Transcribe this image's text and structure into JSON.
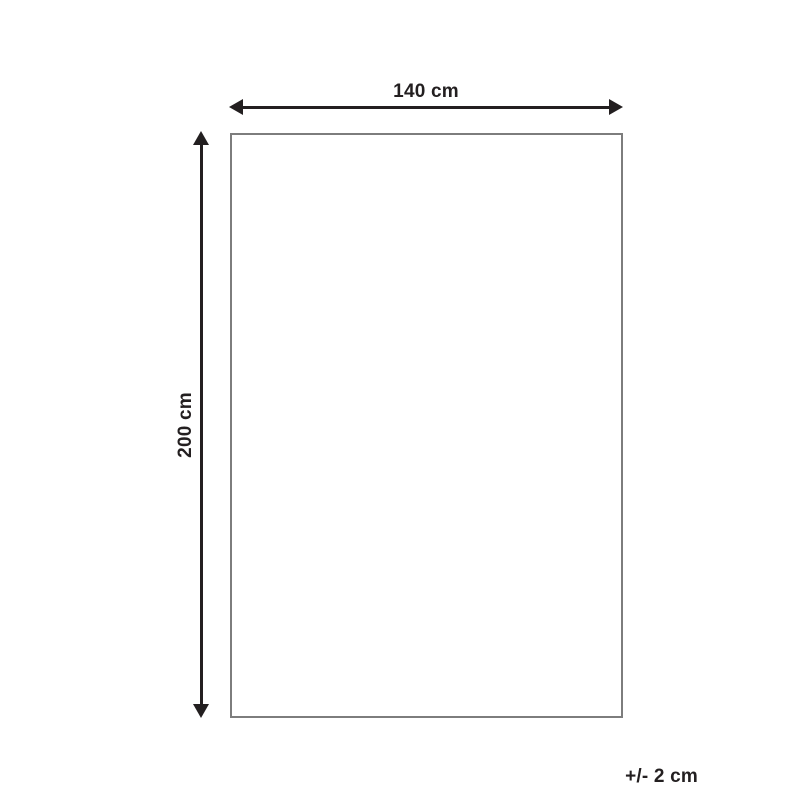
{
  "diagram": {
    "type": "product-dimension-diagram",
    "width_label": "140 cm",
    "height_label": "200 cm",
    "tolerance_label": "+/- 2 cm",
    "colors": {
      "arrow": "#231f20",
      "text": "#231f20",
      "rectangle_border": "#7d7d7d",
      "background": "#ffffff"
    }
  }
}
